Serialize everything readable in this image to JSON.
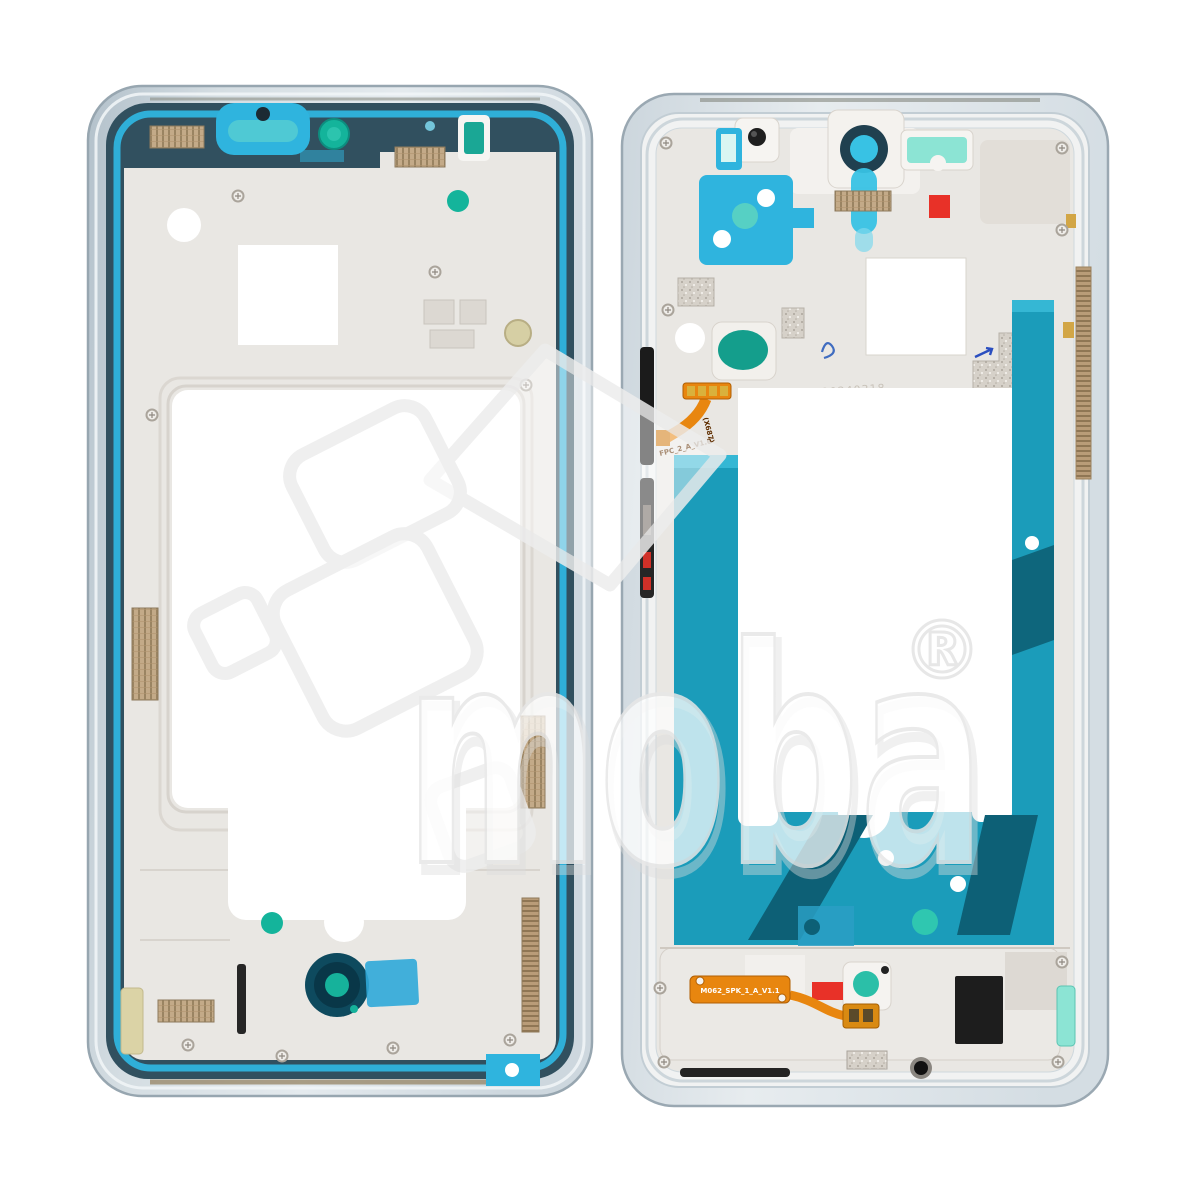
{
  "image": {
    "kind": "product photo",
    "subject": "Smartphone middle frame housing, front and back views, on white background",
    "background": "#ffffff"
  },
  "watermark": {
    "brand": "moba",
    "registered": "®"
  },
  "markings": {
    "top_flex_code_vertical": "(X687)",
    "top_flex_label": "FPC_2_A_V1.0",
    "bottom_flex_label": "M062_SPK_1_A_V1.1",
    "engraved_date": "20240318"
  },
  "colors": {
    "frame_silver": "#c9d3da",
    "frame_silver_light": "#e2e8ec",
    "metal_plate": "#e9e7e3",
    "adhesive_navy": "#31505f",
    "adhesive_cyan": "#2fb4de",
    "adhesive_teal": "#1b9cba",
    "adhesive_teal_dark": "#0d6076",
    "accent_teal_dot": "#14b49b",
    "flex_orange": "#e8860f",
    "sticker_red": "#e83128",
    "mint": "#8ce4d4",
    "gold_mesh": "#c3aa88",
    "bronze_strip": "#b99c78",
    "watermark_gray": "#e9e9e9"
  }
}
